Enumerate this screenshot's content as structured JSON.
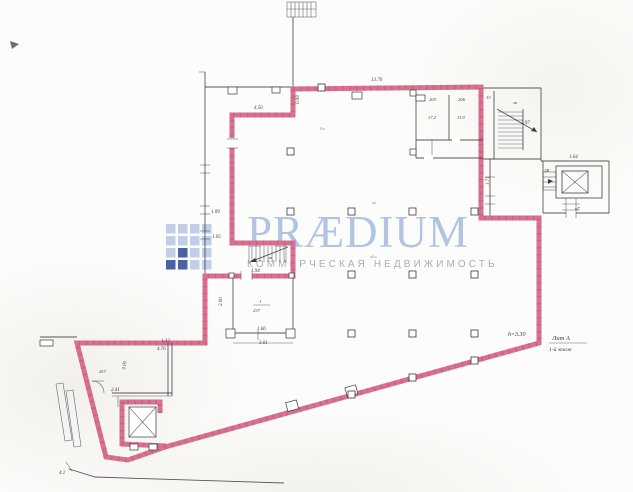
{
  "colors": {
    "paper": "#fcfcfa",
    "ink": "#3a3a42",
    "pink": "#d8718f",
    "pinkDark": "#b35074",
    "wmBlue": "#a9bfdf",
    "wmGray": "#a3abb5",
    "logoLight": "#b5c5e4",
    "logoDark": "#2b4795"
  },
  "watermark": {
    "wordmark": "PRÆDIUM",
    "subtitle": "КОММЕРЧЕСКАЯ НЕДВИЖИМОСТЬ",
    "logo": {
      "x": 166,
      "y": 224,
      "cell": 9.5,
      "gap": 2.5,
      "rows": [
        "llll",
        "llll",
        "ldll",
        "ddll"
      ]
    }
  },
  "plan": {
    "annotations": {
      "height": "h=3.30",
      "liter": "Лит А",
      "floor": "1-й этаж"
    },
    "dimensions": [
      {
        "t": "13.70",
        "x": 371,
        "y": 81
      },
      {
        "t": "4.50",
        "x": 254,
        "y": 109
      },
      {
        "t": "0.98",
        "x": 299,
        "y": 104,
        "r": -90
      },
      {
        "t": "1.09",
        "x": 211,
        "y": 213
      },
      {
        "t": "1.05",
        "x": 212,
        "y": 238
      },
      {
        "t": "4.76",
        "x": 157,
        "y": 350
      },
      {
        "t": "1.94",
        "x": 251,
        "y": 272
      },
      {
        "t": "2.00",
        "x": 222,
        "y": 306,
        "r": -90
      },
      {
        "t": "1.66",
        "x": 257,
        "y": 330
      },
      {
        "t": "3.01",
        "x": 259,
        "y": 344
      },
      {
        "t": "2.41",
        "x": 111,
        "y": 391
      },
      {
        "t": "3.05",
        "x": 125,
        "y": 370,
        "r": -80
      },
      {
        "t": "1.32",
        "x": 161,
        "y": 342
      },
      {
        "t": "4.1",
        "x": 59,
        "y": 474
      },
      {
        "t": "1.64",
        "x": 569,
        "y": 158
      },
      {
        "t": "1.71",
        "x": 489,
        "y": 185,
        "r": -90
      },
      {
        "t": "2.97",
        "x": 521,
        "y": 124
      }
    ],
    "room_labels": [
      {
        "t": "205",
        "x": 429,
        "y": 101
      },
      {
        "t": "17.2",
        "x": 428,
        "y": 119
      },
      {
        "t": "206",
        "x": 458,
        "y": 101
      },
      {
        "t": "11.9",
        "x": 457,
        "y": 119
      },
      {
        "t": "13",
        "x": 486,
        "y": 99
      },
      {
        "t": "лк",
        "x": 513,
        "y": 104
      },
      {
        "t": "1",
        "x": 259,
        "y": 303
      },
      {
        "t": "237",
        "x": 253,
        "y": 312
      },
      {
        "t": "257",
        "x": 99,
        "y": 373
      },
      {
        "t": "лк",
        "x": 268,
        "y": 259
      },
      {
        "t": "вн",
        "x": 372,
        "y": 204,
        "f": 1
      },
      {
        "t": "вЬх",
        "x": 370,
        "y": 258,
        "f": 1
      },
      {
        "t": "8м",
        "x": 320,
        "y": 130,
        "f": 1
      },
      {
        "t": "2В",
        "x": 544,
        "y": 172
      },
      {
        "t": "кГ",
        "x": 575,
        "y": 210
      }
    ]
  }
}
